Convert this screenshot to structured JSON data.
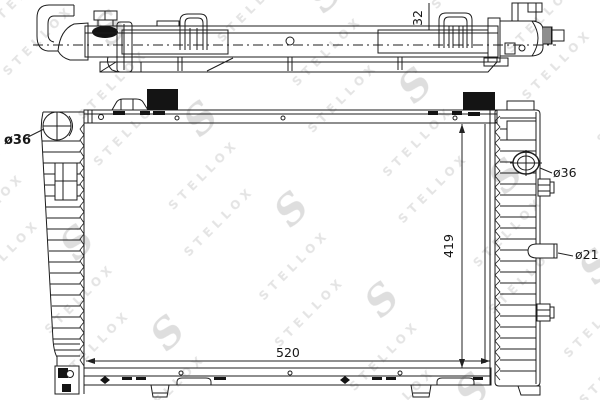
{
  "watermark": {
    "text": "STELLOX",
    "logo": "S"
  },
  "drawing": {
    "dimensions": {
      "top_depth": "32",
      "core_height": "419",
      "core_width": "520",
      "left_inlet_diameter": "ø36",
      "right_inlet_diameter": "ø36",
      "drain_pipe_diameter": "ø21"
    }
  }
}
